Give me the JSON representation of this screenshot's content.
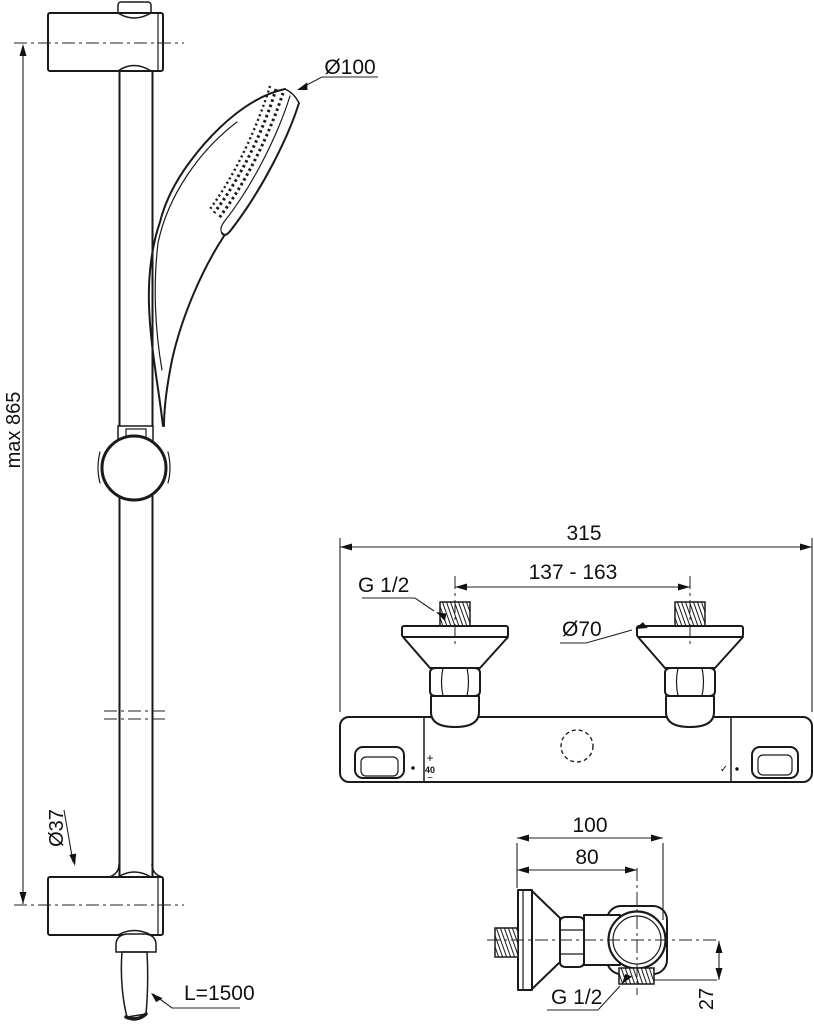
{
  "colors": {
    "line": "#1a1a1a",
    "hose_gray": "#b3b3b3",
    "background": "#ffffff"
  },
  "views": {
    "slide_rail": {
      "max_height_label": "max 865",
      "handset_diameter_label": "Ø100",
      "bracket_diameter_label": "Ø37",
      "hose_length_label": "L=1500"
    },
    "mixer_front": {
      "overall_width_label": "315",
      "inlet_centers_label": "137 - 163",
      "inlet_thread_label": "G 1/2",
      "escutcheon_diameter_label": "Ø70",
      "temp_plus_label": "+",
      "temp_value_label": "40",
      "temp_minus_label": "−",
      "flow_mark_label": "✓"
    },
    "mixer_side": {
      "overall_depth_label": "100",
      "wall_to_axis_label": "80",
      "outlet_thread_label": "G 1/2",
      "outlet_offset_label": "27"
    }
  }
}
